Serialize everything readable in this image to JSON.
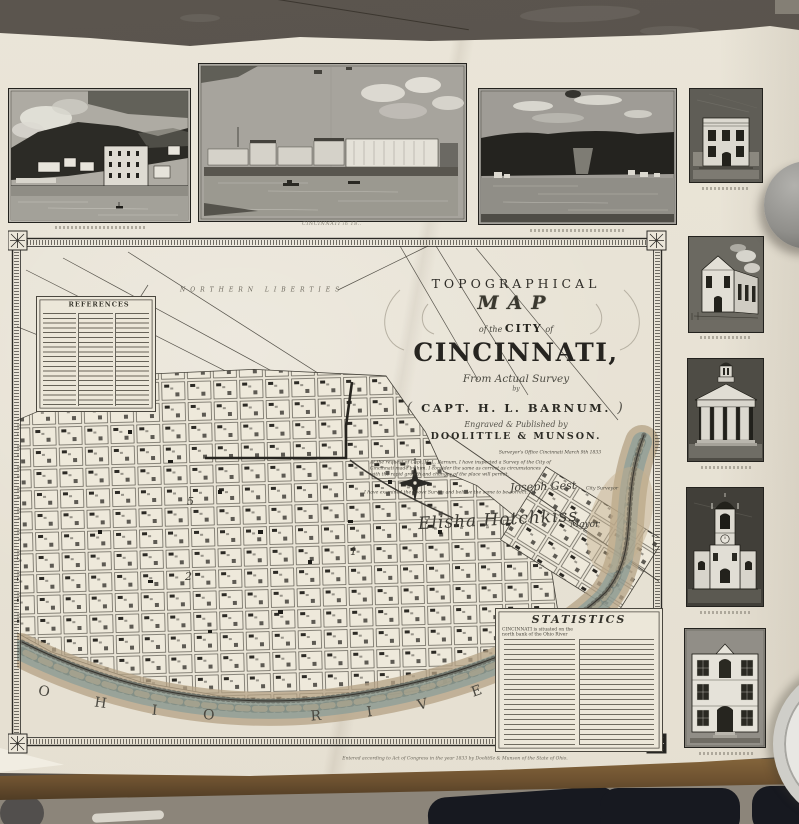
{
  "map": {
    "title": {
      "line1": "TOPOGRAPHICAL",
      "line2": "MAP",
      "line3_pre": "of the",
      "line3_mid": "CITY",
      "line3_post": "of",
      "line4": "CINCINNATI,",
      "line5": "From Actual Survey",
      "line6": "by",
      "line7": "CAPT. H. L. BARNUM.",
      "line7_flourish_left": "(",
      "line7_flourish_right": ")",
      "line8": "Engraved & Published by",
      "line9": "DOOLITTLE & MUNSON."
    },
    "district_label": "NORTHERN LIBERTIES",
    "legend_title": "REFERENCES",
    "stats_title": "STATISTICS",
    "stats_lead": "CINCINNATI is situated on the north bank of the Ohio River",
    "river_label": "OHIO RIVER",
    "wards": [
      "5",
      "2",
      "1"
    ],
    "certification": {
      "office_line": "Surveyor's Office Cincinnati March 9th 1833",
      "body1": "At the request of Capt. H. L. Barnum, I have inspected a Survey of the City of",
      "body2": "Cincinnati made by him. I consider the same as correct as circumstances",
      "body3": "with the rapid growth and changes of the place will permit.",
      "surveyor_signature": "Joseph Gest",
      "surveyor_title": "City Surveyor",
      "mayor_line": "I have examined the above Survey and believe the same to be correct.",
      "mayor_signature": "Elisha Hotchkiss",
      "mayor_title": "Mayor"
    },
    "imprint": "Entered according to Act of Congress in the year 1833 by Doolittle & Munson of the State of Ohio."
  },
  "views": {
    "caption2": "CINCINNATI in 18.."
  },
  "colors": {
    "paper": "#e9e4d7",
    "ink": "#2b2a26",
    "river_teal": "#7e9a99",
    "shore_tan": "#b4a184",
    "table_brown": "#6d5130",
    "background": "#57514a"
  }
}
